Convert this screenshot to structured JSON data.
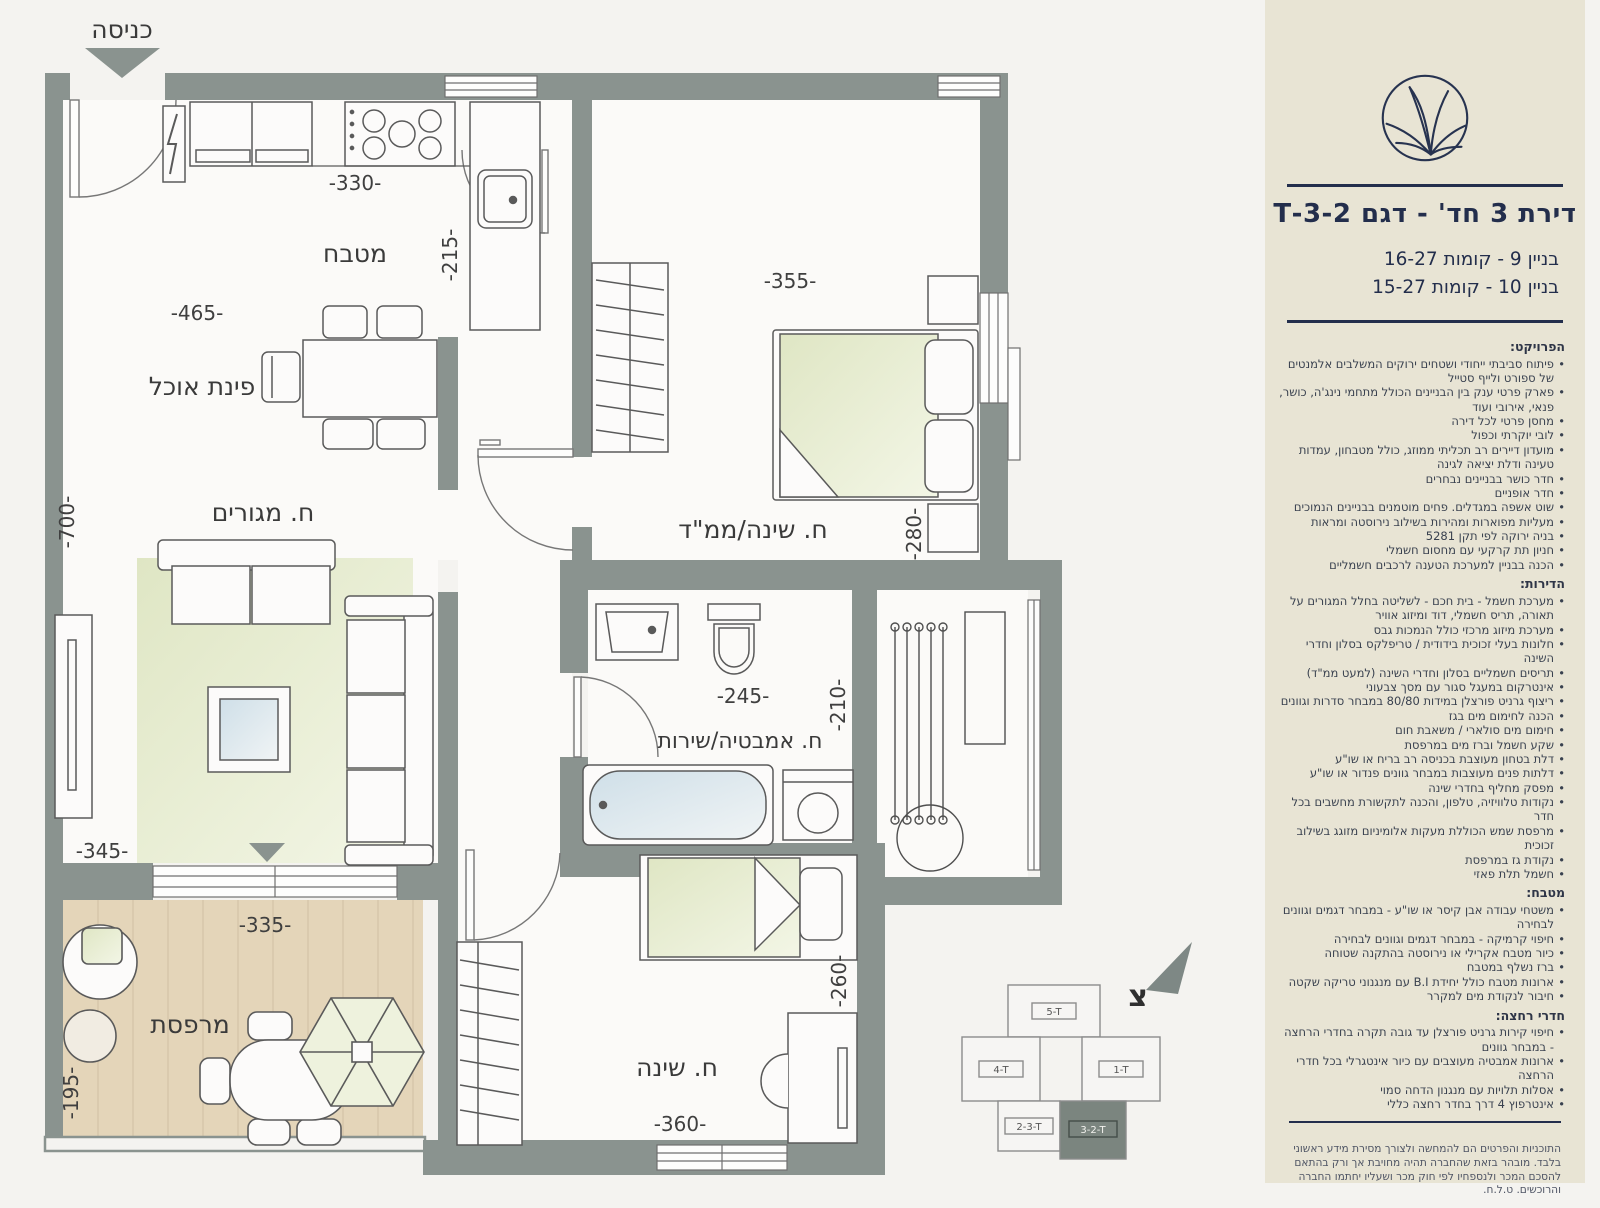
{
  "plan": {
    "entrance_label": "כניסה",
    "north_letter": "צ",
    "rooms": {
      "kitchen": "מטבח",
      "dining": "פינת אוכל",
      "living": "ח. מגורים",
      "master": "ח. שינה/ממ\"ד",
      "bath": "ח. אמבטיה/שירות",
      "bed2": "ח. שינה",
      "balcony": "מרפסת"
    },
    "dims": {
      "d330": "-330-",
      "d215": "-215-",
      "d465": "-465-",
      "d700": "-700-",
      "d355": "-355-",
      "d280": "-280-",
      "d245": "-245-",
      "d210": "-210-",
      "d345": "-345-",
      "d335": "-335-",
      "d195": "-195-",
      "d260": "-260-",
      "d360": "-360-"
    },
    "keyplan": {
      "u5": "5-T",
      "u4": "4-T",
      "u1": "1-T",
      "u23": "2-3-T",
      "u32": "3-2-T"
    }
  },
  "sidebar": {
    "title": "דירת 3 חד' - דגם 3-2-T",
    "building_lines": [
      "בניין 9  - קומות 16-27",
      "בניין 10 - קומות 15-27"
    ],
    "specs": [
      {
        "heading": "הפרויקט:",
        "items": [
          "פיתוח סביבתי ייחודי ושטחים ירוקים המשלבים אלמנטים של ספורט ולייף סטייל",
          "פארק פרטי ענק בין הבניינים הכולל מתחמי נינג'ה, כושר, פנאי, אירובי ועוד",
          "מחסן פרטי לכל דירה",
          "לובי יוקרתי וכפול",
          "מועדון דיירים רב תכליתי ממוזג, כולל מטבחון, עמדות טעינה ודלת יציאה לגינה",
          "חדר כושר בבניינים נבחרים",
          "חדר אופניים",
          "שוט אשפה במגדלים. פחים מוטמנים בבניינים הנמוכים",
          "מעליות מפוארות ומהירות בשילוב נירוסטה ומראות",
          "בניה ירוקה לפי תקן 5281",
          "חניון תת קרקעי עם מחסום חשמלי",
          "הכנה בבניין למערכת הטענה לרכבים חשמליים"
        ]
      },
      {
        "heading": "הדירות:",
        "items": [
          "מערכת חשמל - בית חכם - לשליטה בחלל המגורים על תאורה, תריס חשמלי, דוד ומיזוג אוויר",
          "מערכת מיזוג מרכזי כולל הנמכות גבס",
          "חלונות בעלי זכוכית בידודית / טריפלקס בסלון וחדרי השינה",
          "תריסים חשמליים בסלון וחדרי השינה (למעט ממ\"ד)",
          "אינטרקום במעגל סגור עם מסך צבעוני",
          "ריצוף גרניט פורצלן במידות 80/80 במבחר סדרות וגוונים",
          "הכנה לחימום מים בגז",
          "חימום מים סולארי / משאבת חום",
          "שקע חשמל וברז מים במרפסת",
          "דלת בטחון מעוצבת בכניסה רב בריח או שו\"ע",
          "דלתות פנים מעוצבות במבחר גוונים פנדור או שו\"ע",
          "מפסק מחליף בחדרי שינה",
          "נקודות טלוויזיה, טלפון, והכנה לתקשורת מחשבים בכל חדר",
          "מרפסת שמש הכוללת מעקות אלומיניום מזוגג בשילוב זכוכית",
          "נקודת גז במרפסת",
          "חשמל תלת פאזי"
        ]
      },
      {
        "heading": "מטבח:",
        "items": [
          "משטחי עבודה אבן קיסר או שו\"ע - במבחר דגמים וגוונים לבחירה",
          "חיפוי קרמיקה - במבחר דגמים וגוונים לבחירה",
          "כיור מטבח אקרילי או נירוסטה בהתקנה שטוחה",
          "ברז נשלף במטבח",
          "ארונות מטבח כולל יחידת B.I עם מנגנוני טריקה שקטה",
          "חיבור לנקודת מים למקרר"
        ]
      },
      {
        "heading": "חדרי רחצה:",
        "items": [
          "חיפוי קירות גרניט פורצלן עד גובה תקרה בחדרי הרחצה - במבחר גוונים",
          "ארונות אמבטיה מעוצבים עם כיור אינטגרלי בכל חדרי הרחצה",
          "אסלות תלויות עם מנגנון הדחה סמוי",
          "אינטרפוץ 4 דרך בחדר רחצה כללי"
        ]
      }
    ],
    "disclaimer": "התוכניות והפרטים הם להמחשה ולצורך מסירת מידע ראשוני בלבד. מובהר בזאת שהחברה תהיה מחויבת אך ורק בהתאם להסכם המכר ולנספחיו לפי חוק מכר ושעליו יחתמו החברה והרוכשים. ט.ל.ח."
  },
  "colors": {
    "wall": "#8a938f",
    "panel": "#e8e4d4",
    "navy": "#232e4c",
    "wood": "#e4d5b9",
    "green": "#e7ecd2"
  }
}
